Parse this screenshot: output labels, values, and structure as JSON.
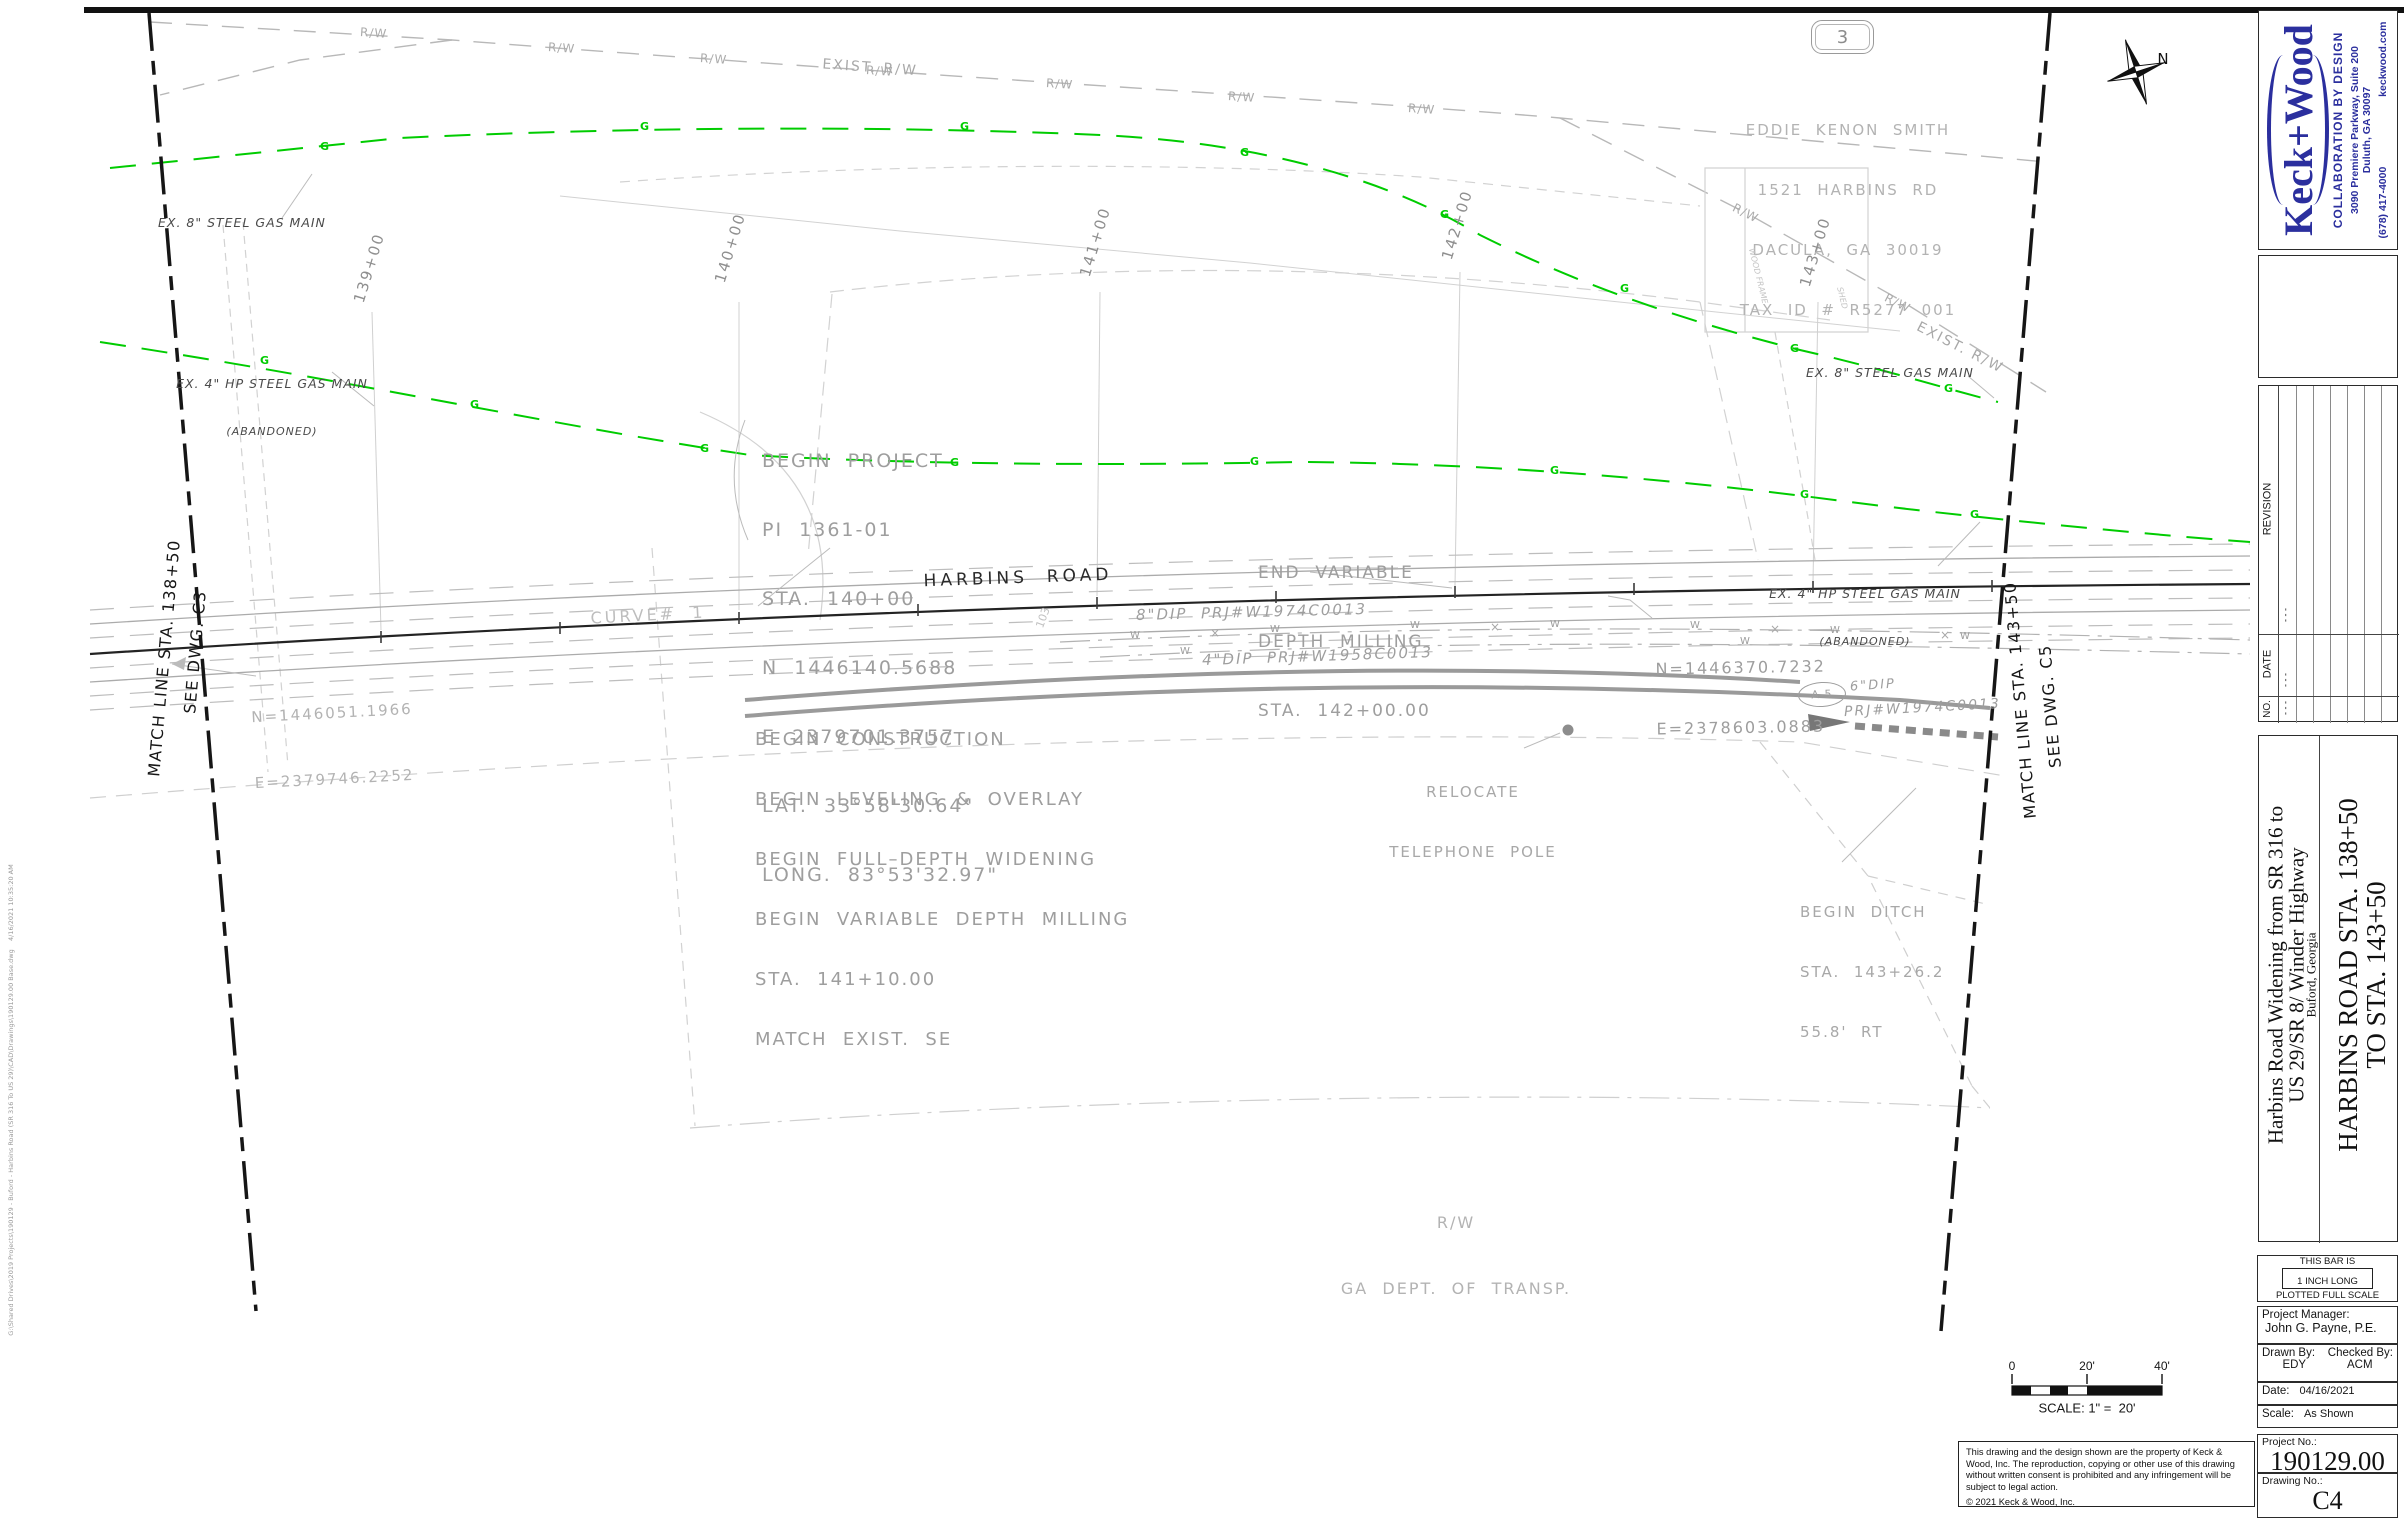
{
  "colors": {
    "accent_blue": "#2b2f9e",
    "gas_green": "#00cc00"
  },
  "titleblock": {
    "logo": {
      "name": "Keck+Wood",
      "tagline": "COLLABORATION BY DESIGN",
      "address1": "3090 Premiere Parkway, Suite 200",
      "address2": "Duluth, GA  30097",
      "phone": "(678) 417-4000",
      "website": "keckwood.com"
    },
    "revision_table": {
      "col_revision": "REVISION",
      "col_date": "DATE",
      "col_no": "NO.",
      "dash": "- - -"
    },
    "project_title": {
      "line1": "Harbins Road Widening from SR 316 to",
      "line2": "US 29/SR 8/ Winder Highway",
      "line3": "Buford, Georgia"
    },
    "sheet_title": {
      "line1": "HARBINS ROAD STA. 138+50",
      "line2": "TO STA. 143+50"
    },
    "bar_note": {
      "l1": "THIS BAR IS",
      "l2": "1 INCH LONG",
      "l3": "PLOTTED FULL SCALE"
    },
    "pm": {
      "label": "Project Manager:",
      "value": "John G. Payne, P.E."
    },
    "drawn": {
      "label": "Drawn By:",
      "value": "EDY"
    },
    "checked": {
      "label": "Checked By:",
      "value": "ACM"
    },
    "date": {
      "label": "Date:",
      "value": "04/16/2021"
    },
    "scale": {
      "label": "Scale:",
      "value": "As Shown"
    },
    "project_no": {
      "label": "Project No.:",
      "value": "190129.00"
    },
    "drawing_no": {
      "label": "Drawing No.:",
      "value": "C4"
    }
  },
  "drawing": {
    "sheet_ref": "3",
    "north_label": "N",
    "owner": [
      "EDDIE  KENON  SMITH",
      "1521  HARBINS  RD",
      "DACULA,  GA  30019",
      "TAX  ID  #  R5277  001"
    ],
    "exist_rw": "EXIST. R/W",
    "rw": "R/W",
    "gas8_label": "EX. 8\" STEEL GAS MAIN",
    "gas4_label_1": "EX. 4\" HP STEEL GAS MAIN",
    "gas4_label_2": "(ABANDONED)",
    "g_marker": "G",
    "w_marker": "W",
    "x_marker": "×",
    "stations": [
      "139+00",
      "140+00",
      "141+00",
      "142+00",
      "143+00"
    ],
    "begin_project": [
      "BEGIN  PROJECT",
      "PI  1361-01",
      "STA.  140+00",
      "N  1446140.5688",
      "E  2379701.3757",
      "LAT.  33°58'30.64\"",
      "LONG.  83°53'32.97\""
    ],
    "end_milling": [
      "END  VARIABLE",
      "DEPTH  MILLING",
      "STA.  142+00.00"
    ],
    "begin_construction": [
      "BEGIN  CONSTRUCTION",
      "BEGIN  LEVELING  &  OVERLAY",
      "BEGIN  FULL–DEPTH  WIDENING",
      "BEGIN  VARIABLE  DEPTH  MILLING",
      "STA.  141+10.00",
      "MATCH  EXIST.  SE"
    ],
    "harbins_road": "HARBINS  ROAD",
    "curve1": "CURVE#  1",
    "coord_left": [
      "N=1446051.1966",
      "E=2379746.2252"
    ],
    "coord_right": [
      "N=1446370.7232",
      "E=2378603.0883"
    ],
    "dip8": "8\"DIP  PRJ#W1974C0013",
    "dip4": "4\"DIP  PRJ#W1958C0013",
    "a5": "A-5",
    "dip6": "6\"DIP",
    "prj_right": "PRJ#W1974C0013",
    "relocate": [
      "RELOCATE",
      "TELEPHONE  POLE"
    ],
    "begin_ditch": [
      "BEGIN  DITCH",
      "STA.  143+26.2",
      "55.8'  RT"
    ],
    "rw_dept": [
      "R/W",
      "GA  DEPT.  OF  TRANSP."
    ],
    "matchline_left": [
      "MATCH LINE STA. 138+50",
      "SEE DWG. C3"
    ],
    "matchline_right": [
      "MATCH LINE STA. 143+50",
      "SEE DWG. C5"
    ],
    "parcel_no": "103",
    "house_label_1": "WOOD FRAME",
    "house_label_2": "SHED",
    "scalebar": {
      "t0": "0",
      "t20": "20'",
      "t40": "40'",
      "caption": "SCALE: 1\" =  20'"
    },
    "copyright": {
      "body": "This drawing and the design shown are the property of Keck & Wood, Inc. The reproduction, copying or other use of this drawing without written consent is prohibited and any infringement will be subject to legal action.",
      "line": "©  2021 Keck & Wood, Inc."
    },
    "plot_stamp": "G:\\Shared Drives\\2019 Projects\\190129 - Buford - Harbins Road (SR 316 To US 29)\\CAD\\Drawings\\190129.00 Base.dwg    4/16/2021 10:35:20 AM"
  }
}
